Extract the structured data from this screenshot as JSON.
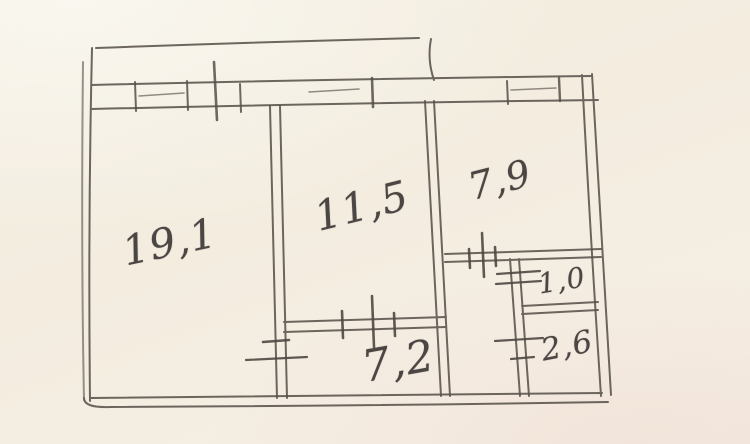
{
  "drawing": {
    "description": "hand-drawn apartment floor plan sketch in pencil",
    "units_visible": false
  },
  "rooms": [
    {
      "id": "room-large-left",
      "label": "19,1",
      "area_value": 19.1
    },
    {
      "id": "room-middle",
      "label": "11,5",
      "area_value": 11.5
    },
    {
      "id": "room-top-right",
      "label": "7,9",
      "area_value": 7.9
    },
    {
      "id": "corridor-bottom",
      "label": "7,2",
      "area_value": 7.2
    },
    {
      "id": "small-room-upper",
      "label": "1,0",
      "area_value": 1.0
    },
    {
      "id": "small-room-lower",
      "label": "2,6",
      "area_value": 2.6
    }
  ],
  "colors": {
    "paper": "#f4eee1",
    "pencil_line": "#59534c",
    "handwriting": "#4b4643"
  }
}
